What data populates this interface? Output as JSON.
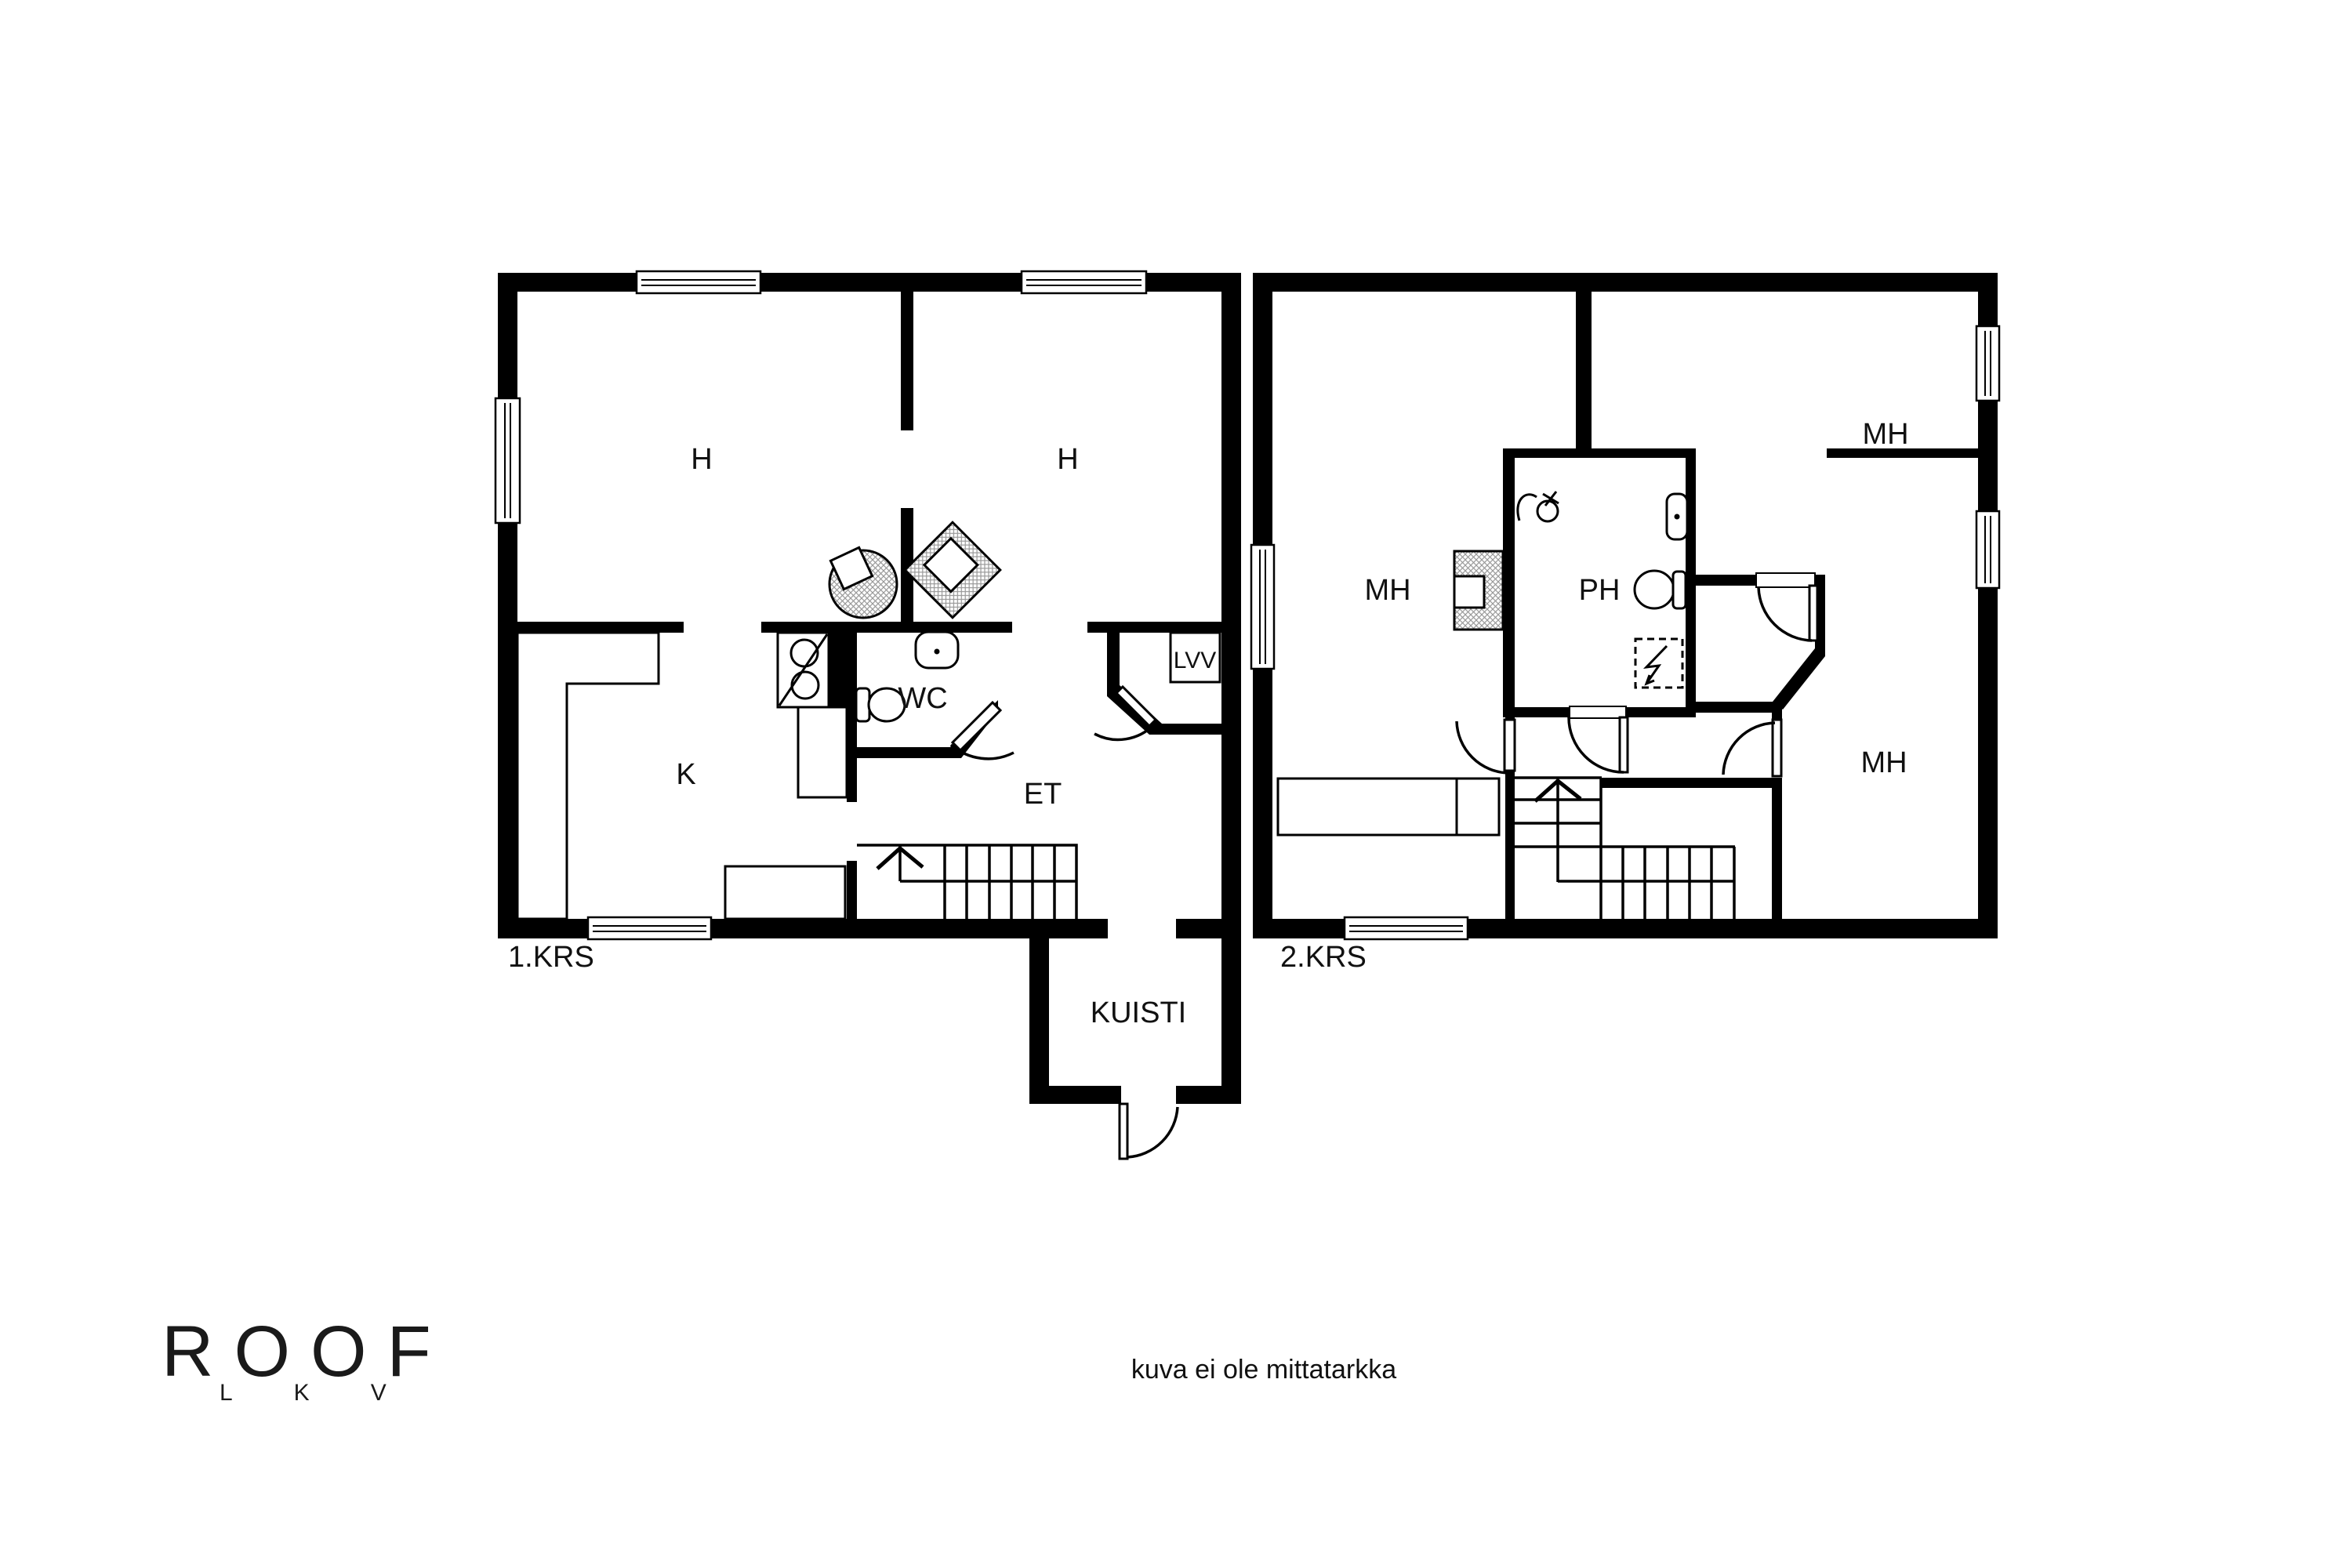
{
  "floors": [
    {
      "label": "1.KRS",
      "rooms": [
        {
          "key": "room-h-left",
          "label": "H"
        },
        {
          "key": "room-h-right",
          "label": "H"
        },
        {
          "key": "kitchen",
          "label": "K"
        },
        {
          "key": "wc",
          "label": "WC"
        },
        {
          "key": "entry-hall",
          "label": "ET"
        },
        {
          "key": "water-heater-closet",
          "label": "LVV"
        },
        {
          "key": "porch",
          "label": "KUISTI"
        }
      ]
    },
    {
      "label": "2.KRS",
      "rooms": [
        {
          "key": "bedroom-left",
          "label": "MH"
        },
        {
          "key": "bathroom",
          "label": "PH"
        },
        {
          "key": "bedroom-top-right",
          "label": "MH"
        },
        {
          "key": "bedroom-bottom-right",
          "label": "MH"
        }
      ]
    }
  ],
  "footer": {
    "disclaimer": "kuva ei ole mittatarkka"
  },
  "logo": {
    "name": "ROOF",
    "subtitle": "LKV"
  },
  "colors": {
    "wall": "#000000",
    "background": "#ffffff",
    "hatch": "#9a9a9a",
    "text": "#111111"
  }
}
